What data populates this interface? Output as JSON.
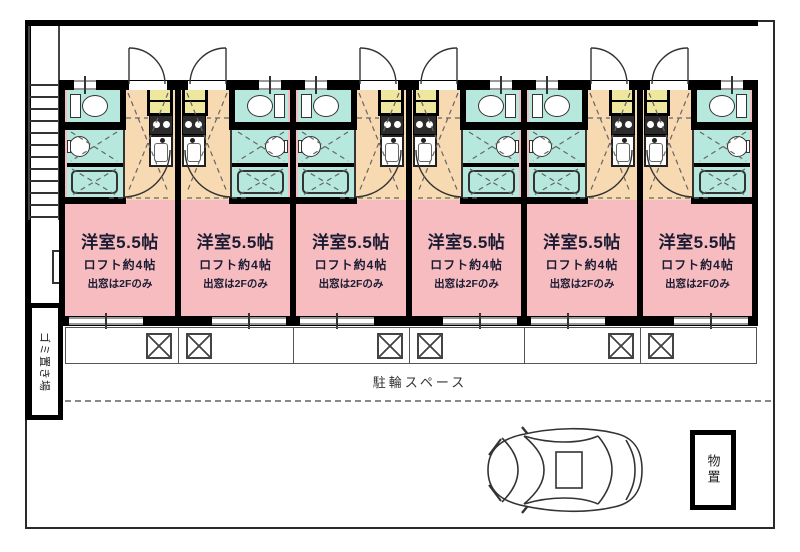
{
  "floorplan": {
    "units": {
      "count": 6,
      "room_label": "洋室5.5帖",
      "loft_label": "ロフト約4帖",
      "window_note": "出窓は2Fのみ"
    },
    "labels": {
      "bike_parking": "駐輪スペース",
      "garbage_area": "ゴミ置き場",
      "storage": "物置"
    },
    "colors": {
      "room_pink": "#f6bcc0",
      "wet_area_cyan": "#b6e8de",
      "entry_orange": "#f7d9b2",
      "tile_yellow": "#efe79e",
      "wall_black": "#000000"
    }
  }
}
